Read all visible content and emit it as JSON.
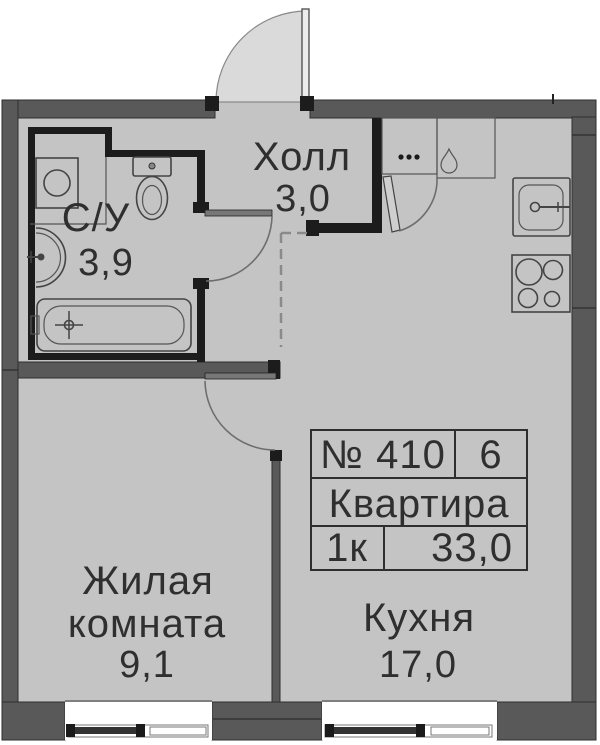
{
  "rooms": {
    "hall": {
      "label": "Холл",
      "area": "3,0"
    },
    "bathroom": {
      "label": "С/У",
      "area": "3,9"
    },
    "living_room": {
      "label_line1": "Жилая",
      "label_line2": "комната",
      "area": "9,1"
    },
    "kitchen": {
      "label": "Кухня",
      "area": "17,0"
    }
  },
  "info_table": {
    "unit_number": "№ 410",
    "entrance": "6",
    "type_label": "Квартира",
    "rooms_count": "1к",
    "total_area": "33,0"
  },
  "colors": {
    "floor": "#c4c4c4",
    "outer_wall": "#595959",
    "inner_wall": "#1c1c1c",
    "door_swing": "#dadada",
    "fixture_line": "#444444",
    "text": "#2f2f2f"
  }
}
